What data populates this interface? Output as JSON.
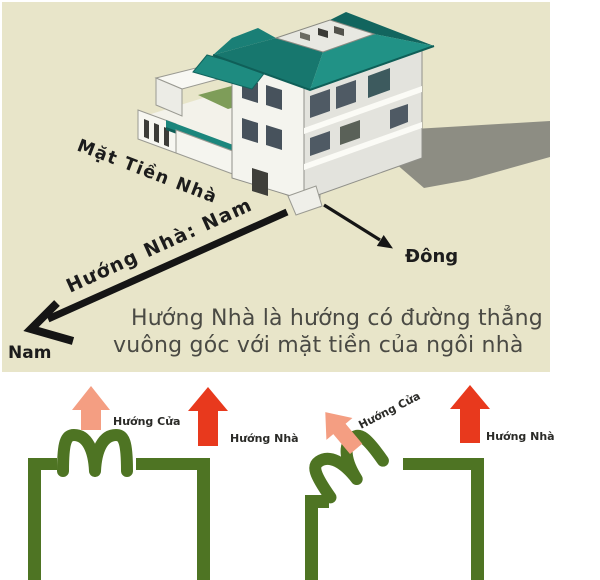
{
  "top_panel": {
    "facade_label": "Mặt Tiền Nhà",
    "direction_arrow_label": "Hướng Nhà: Nam",
    "south_label": "Nam",
    "east_label": "Đông",
    "caption_line1": "Hướng Nhà là hướng có đường thẳng",
    "caption_line2": "vuông góc với mặt tiền của ngôi nhà",
    "colors": {
      "background": "#e8e5c9",
      "roof_teal": "#1f8c81",
      "wall_white": "#f4f4ee",
      "shadow_gray": "#8d8d83",
      "annotation_black": "#1c1c1c"
    }
  },
  "diagrams": {
    "left": {
      "door_label": "Hướng Cửa",
      "house_label": "Hướng Nhà"
    },
    "right": {
      "door_label": "Hướng Cửa",
      "house_label": "Hướng Nhà"
    },
    "colors": {
      "wall_green": "#4e7423",
      "door_arrow_salmon": "#f49e82",
      "house_arrow_red": "#e8391d"
    }
  }
}
